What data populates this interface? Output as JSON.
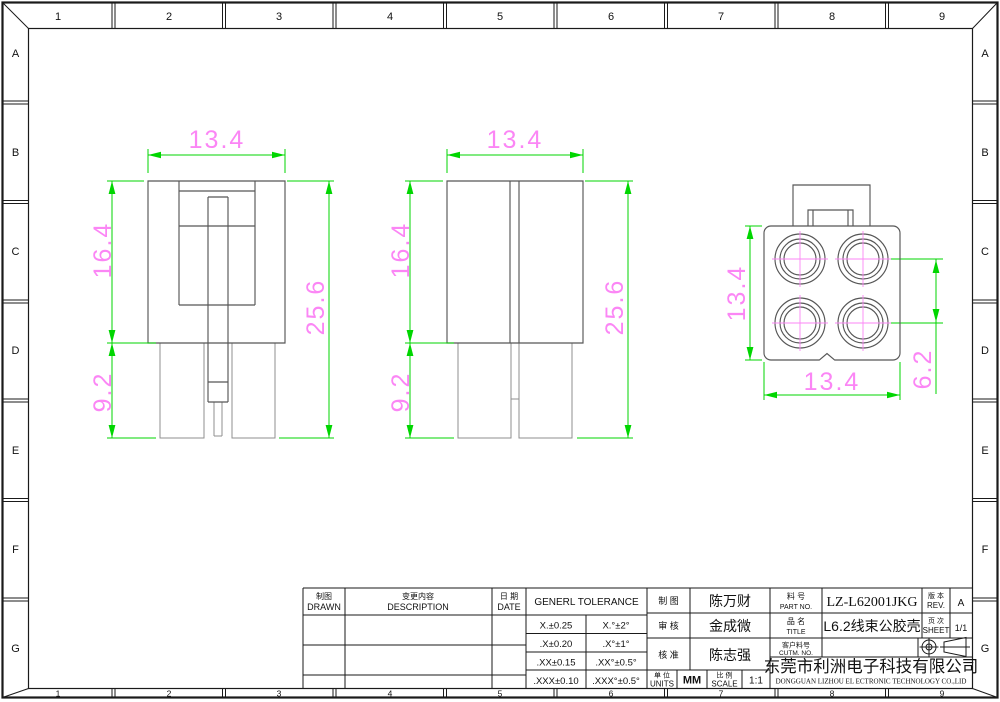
{
  "colors": {
    "dim_line": "#00d600",
    "dim_text": "#fb86f5",
    "outline": "#565656",
    "outline_light": "#8f8f8f",
    "frame": "#1a1a1a",
    "background": "#ffffff"
  },
  "border": {
    "columns": [
      "1",
      "2",
      "3",
      "4",
      "5",
      "6",
      "7",
      "8",
      "9"
    ],
    "rows": [
      "A",
      "B",
      "C",
      "D",
      "E",
      "F",
      "G"
    ]
  },
  "views": {
    "front": {
      "dim_width": "13.4",
      "dim_body_height": "16.4",
      "dim_leg_height": "9.2",
      "dim_total_height": "25.6"
    },
    "side": {
      "dim_width": "13.4",
      "dim_body_height": "16.4",
      "dim_leg_height": "9.2",
      "dim_total_height": "25.6"
    },
    "rear": {
      "dim_height": "13.4",
      "dim_width": "13.4",
      "dim_pitch": "6.2"
    }
  },
  "title_block": {
    "drawn_label_cn": "制图",
    "drawn_label_en": "DRAWN",
    "description_label_cn": "变更内容",
    "description_label_en": "DESCRIPTION",
    "date_label_cn": "日 期",
    "date_label_en": "DATE",
    "tolerance": {
      "header": "GENERL TOLERANCE",
      "rows": [
        [
          "X.±0.25",
          "X.°±2°"
        ],
        [
          ".X±0.20",
          ".X°±1°"
        ],
        [
          ".XX±0.15",
          ".XX°±0.5°"
        ],
        [
          ".XXX±0.10",
          ".XXX°±0.5°"
        ]
      ]
    },
    "signoff": [
      {
        "label": "制 图",
        "name": "陈万财"
      },
      {
        "label": "审 核",
        "name": "金成微"
      },
      {
        "label": "核 准",
        "name": "陈志强"
      }
    ],
    "units_label_cn": "单 位",
    "units_label_en": "UNITS",
    "units_value": "MM",
    "scale_label_cn": "比 例",
    "scale_label_en": "SCALE",
    "scale_value": "1:1",
    "part_no_label_cn": "料 号",
    "part_no_label_en": "PART NO.",
    "part_no": "LZ-L62001JKG",
    "title_label_cn": "品 名",
    "title_label_en": "TITLE",
    "title": "L6.2线束公胶壳",
    "customer_label_cn": "客户料号",
    "customer_label_en": "CUTM. NO.",
    "customer_value": "",
    "rev_label_cn": "版 本",
    "rev_label_en": "REV.",
    "rev": "A",
    "sheet_label_cn": "页 次",
    "sheet_label_en": "SHEET",
    "sheet": "1/1",
    "company_cn": "东莞市利洲电子科技有限公司",
    "company_en": "DONGGUAN LIZHOU EL ECTRONIC TECHNOLOGY CO.,LID"
  }
}
